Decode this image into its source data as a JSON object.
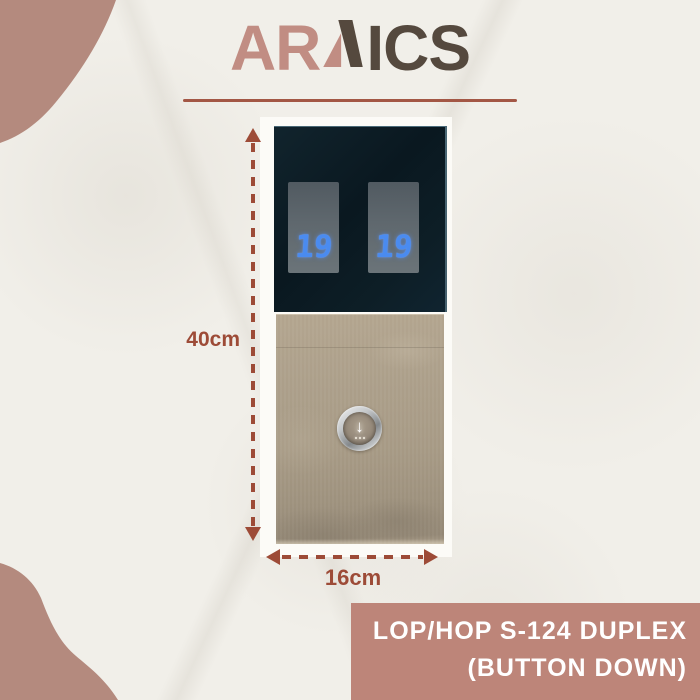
{
  "brand": {
    "name": "ARNICS",
    "logo_prefix": "AR",
    "logo_suffix": "ICS",
    "rose_color": "#c18d83",
    "dark_color": "#55493e",
    "underline_color": "#a35745"
  },
  "panel": {
    "left_display_value": "19",
    "right_display_value": "19",
    "digit_color": "#4a8bf0",
    "housing_color": "#0c1b22",
    "faceplate_color": "#aa9d88",
    "button_arrow_glyph": "↓"
  },
  "dimensions": {
    "height_label": "40cm",
    "width_label": "16cm",
    "annotation_color": "#9d4b37"
  },
  "caption": {
    "line1": "LOP/HOP S-124 DUPLEX",
    "line2": "(BUTTON DOWN)",
    "background_color": "#bd8579",
    "text_color": "#ffffff"
  },
  "decor": {
    "paper_color": "#f1efe9",
    "blob_color": "#b48a7e"
  }
}
